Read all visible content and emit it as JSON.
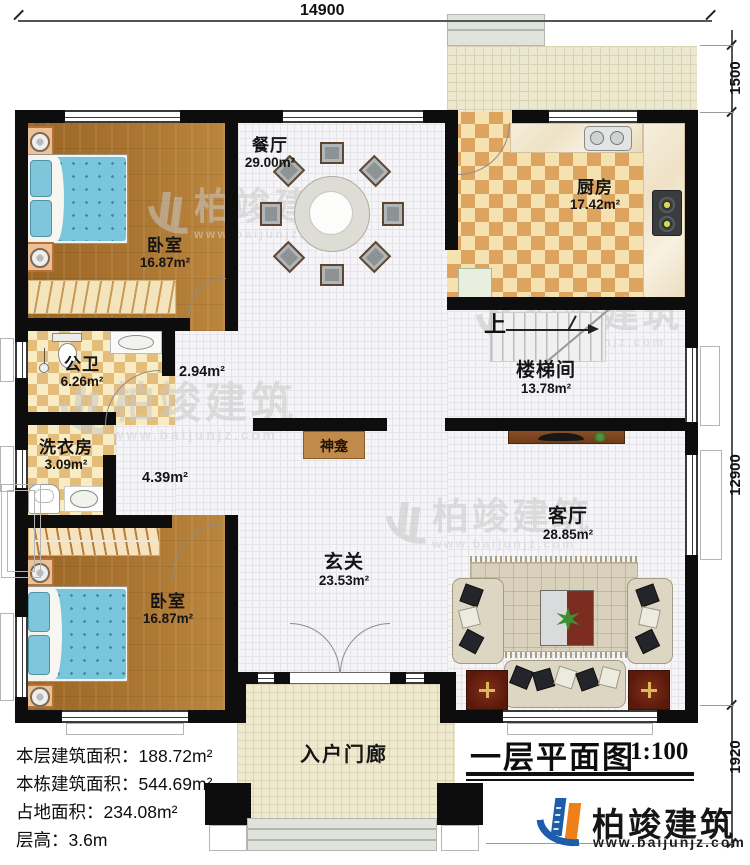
{
  "dims": {
    "top": "14900",
    "right_top": "1500",
    "right_mid": "12900",
    "right_bot": "1920"
  },
  "rooms": {
    "bedroom1": {
      "name": "卧室",
      "area": "16.87m²"
    },
    "dining": {
      "name": "餐厅",
      "area": "29.00m²"
    },
    "kitchen": {
      "name": "厨房",
      "area": "17.42m²"
    },
    "bath": {
      "name": "公卫",
      "area": "6.26m²"
    },
    "laundry": {
      "name": "洗衣房",
      "area": "3.09m²"
    },
    "corr1": {
      "area": "2.94m²"
    },
    "corr2": {
      "area": "4.39m²"
    },
    "stair": {
      "name": "楼梯间",
      "area": "13.78m²",
      "up": "上"
    },
    "shrine": {
      "name": "神龛"
    },
    "foyer": {
      "name": "玄关",
      "area": "23.53m²"
    },
    "living": {
      "name": "客厅",
      "area": "28.85m²"
    },
    "bedroom2": {
      "name": "卧室",
      "area": "16.87m²"
    },
    "porch": {
      "name": "入户门廊"
    }
  },
  "info": {
    "lines": [
      {
        "label": "本层建筑面积：",
        "value": "188.72m²"
      },
      {
        "label": "本栋建筑面积：",
        "value": "544.69m²"
      },
      {
        "label": "占地面积：",
        "value": "234.08m²"
      },
      {
        "label": "层高：",
        "value": "3.6m"
      }
    ]
  },
  "title": {
    "text": "一层平面图",
    "scale": "1:100"
  },
  "brand": {
    "name": "柏竣建筑",
    "url": "www.baijunjz.com"
  },
  "watermark": {
    "name": "柏竣建筑",
    "url": "www.baijunjz.com"
  }
}
